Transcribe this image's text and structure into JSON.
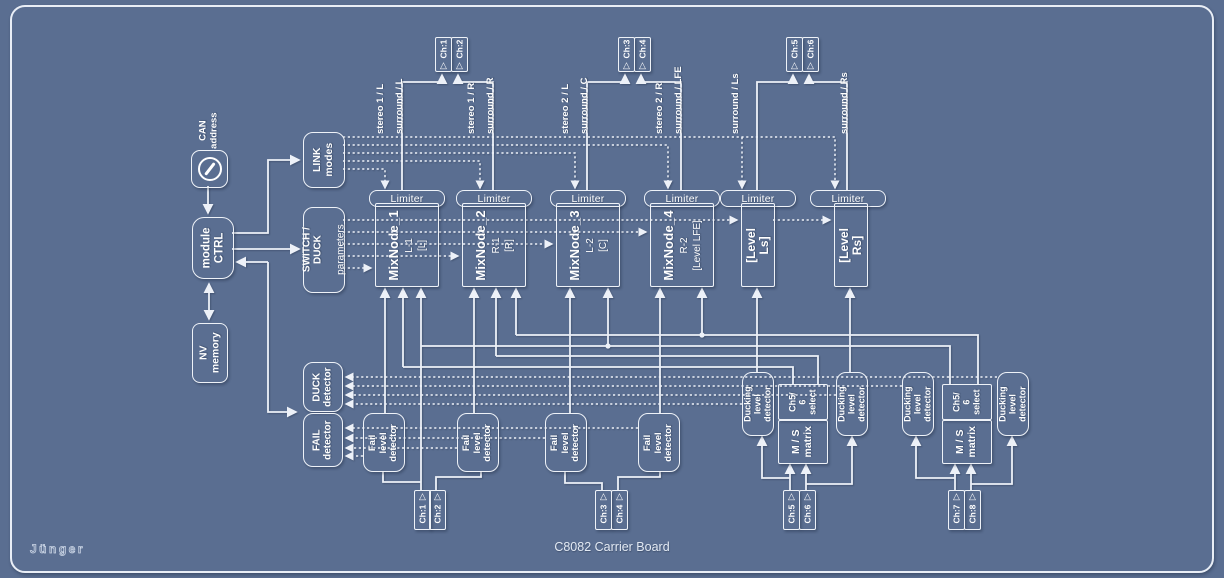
{
  "colors": {
    "background": "#5a6e91",
    "line": "#edf1f8",
    "text": "#ffffff"
  },
  "brand": {
    "logo": "Jünger",
    "caption": "C8082 Carrier Board"
  },
  "control": {
    "can_address": "CAN\naddress",
    "module_ctrl": "module\nCTRL",
    "nv_memory": "NV\nmemory",
    "link_modes": "LINK\nmodes",
    "switch_duck_title": "SWITCH / DUCK",
    "switch_duck_sub": "parameters",
    "duck_detector": "DUCK\ndetector",
    "fail_detector": "FAIL\ndetector"
  },
  "mixnodes": [
    {
      "title": "MixNode_1",
      "line2": "L-1",
      "line3": "[L]"
    },
    {
      "title": "MixNode_2",
      "line2": "R-1",
      "line3": "[R]"
    },
    {
      "title": "MixNode_3",
      "line2": "L-2",
      "line3": "[C]"
    },
    {
      "title": "MixNode_4",
      "line2": "R-2",
      "line3": "[Level LFE]"
    }
  ],
  "levels": [
    {
      "label": "[Level Ls]"
    },
    {
      "label": "[Level Rs]"
    }
  ],
  "limiters": [
    {
      "label": "Limiter"
    },
    {
      "label": "Limiter"
    },
    {
      "label": "Limiter"
    },
    {
      "label": "Limiter"
    },
    {
      "label": "Limiter"
    },
    {
      "label": "Limiter"
    }
  ],
  "fail_level_detectors": [
    {
      "label": "Fail level\ndetector"
    },
    {
      "label": "Fail level\ndetector"
    },
    {
      "label": "Fail level\ndetector"
    },
    {
      "label": "Fail level\ndetector"
    }
  ],
  "ducking_level_detectors": [
    {
      "label": "Ducking level\ndetector"
    },
    {
      "label": "Ducking level\ndetector"
    },
    {
      "label": "Ducking level\ndetector"
    },
    {
      "label": "Ducking level\ndetector"
    }
  ],
  "ch56_selects": [
    {
      "label": "Ch5/\n6\nselect"
    },
    {
      "label": "Ch5/\n6\nselect"
    }
  ],
  "ms_matrices": [
    {
      "label": "M / S\nmatrix"
    },
    {
      "label": "M / S\nmatrix"
    }
  ],
  "outputs_top": [
    {
      "label": "Ch:1"
    },
    {
      "label": "Ch:2"
    },
    {
      "label": "Ch:3"
    },
    {
      "label": "Ch:4"
    },
    {
      "label": "Ch:5"
    },
    {
      "label": "Ch:6"
    }
  ],
  "inputs_bottom": [
    {
      "label": "Ch:1"
    },
    {
      "label": "Ch:2"
    },
    {
      "label": "Ch:3"
    },
    {
      "label": "Ch:4"
    },
    {
      "label": "Ch:5"
    },
    {
      "label": "Ch:6"
    },
    {
      "label": "Ch:7"
    },
    {
      "label": "Ch:8"
    }
  ],
  "signal_labels": [
    {
      "label": "stereo 1 / L"
    },
    {
      "label": "surround / L"
    },
    {
      "label": "stereo 1 / R"
    },
    {
      "label": "surround / R"
    },
    {
      "label": "stereo 2 / L"
    },
    {
      "label": "surround / C"
    },
    {
      "label": "stereo 2 / R"
    },
    {
      "label": "surround / LFE"
    },
    {
      "label": "surround / Ls"
    },
    {
      "label": "surround / Rs"
    }
  ]
}
